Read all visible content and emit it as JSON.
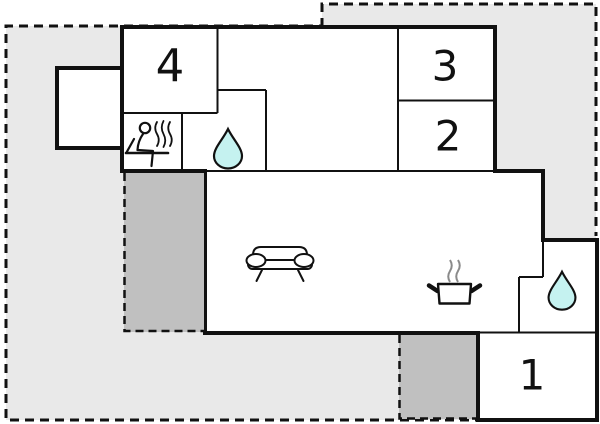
{
  "plan": {
    "type": "holiday-home floor plan",
    "rooms": {
      "room4": {
        "label": "4"
      },
      "room3": {
        "label": "3"
      },
      "room2": {
        "label": "2"
      },
      "room1": {
        "label": "1"
      }
    },
    "icons": {
      "sauna": "sauna-person-steam-icon",
      "bath_upper": "water-drop-icon",
      "bath_lower": "water-drop-icon",
      "living": "sofa-icon",
      "kitchen": "cooking-pot-steam-icon"
    }
  },
  "colors": {
    "background": "#ffffff",
    "wall": "#111111",
    "terrace_light": "#e9e9e9",
    "terrace_dark": "#c0c0c0",
    "water_drop": "#c5f2f0",
    "steam_gray": "#8a8a8a"
  }
}
